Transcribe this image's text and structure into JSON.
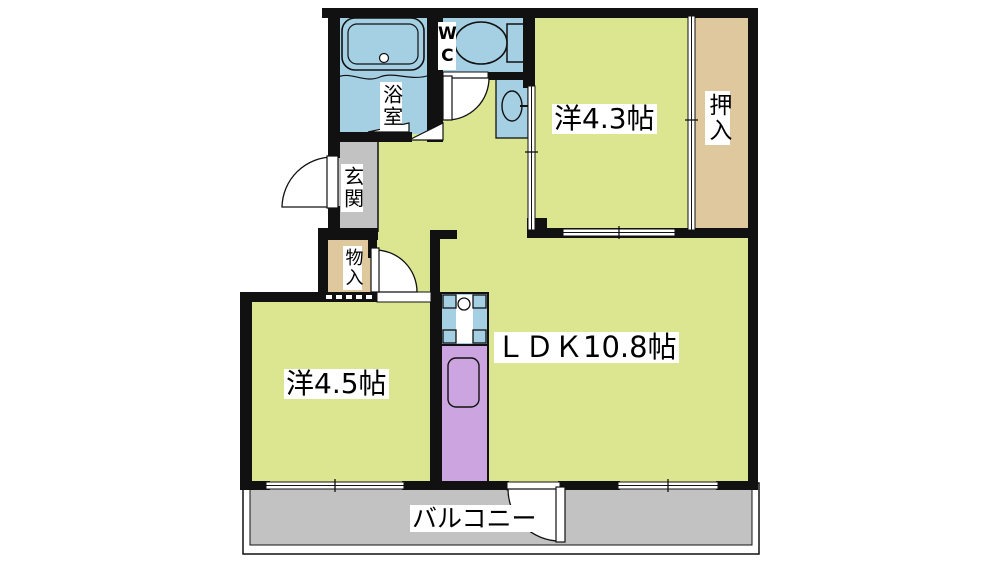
{
  "title": "apartment floor plan",
  "colors": {
    "floor-yellow": "#dce58f",
    "water-blue": "#a5cfe3",
    "closet-tan": "#dfc79e",
    "entry-gray": "#c2c2c2",
    "appliance-purple": "#cba4e0",
    "wall-black": "#111111",
    "bg-white": "#ffffff"
  },
  "rooms": {
    "western_room_4_3": {
      "label": "洋4.3帖"
    },
    "oshiire_closet": {
      "label": "押入"
    },
    "bathroom": {
      "label": "浴室"
    },
    "toilet": {
      "label": "WC"
    },
    "entrance": {
      "label": "玄関"
    },
    "storage": {
      "label": "物入"
    },
    "western_room_4_5": {
      "label": "洋4.5帖"
    },
    "ldk": {
      "label": "ＬＤＫ10.8帖"
    },
    "balcony": {
      "label": "バルコニー"
    }
  }
}
